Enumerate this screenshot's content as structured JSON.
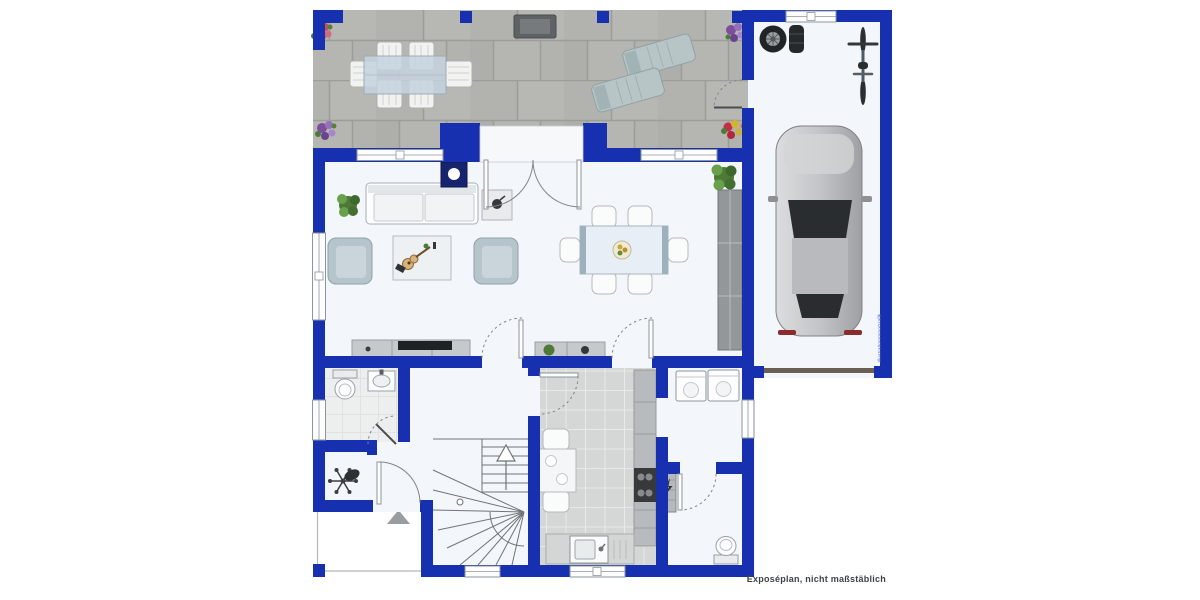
{
  "meta": {
    "type": "floor-plan",
    "footer_note": "Exposéplan, nicht maßstäblich",
    "watermark": "IllustrationImmoGrafik"
  },
  "colors": {
    "wall": "#1630b0",
    "floor": "#f3f6fa",
    "terrace_tile": "#b2b3af",
    "terrace_grout": "#9c9d99",
    "kitchen_tile": "#d4d7d5",
    "wc_tile": "#edefee",
    "cabinet_gray": "#c5c9cc",
    "seat_blue": "#b6c5cb",
    "plant_green": "#4e7a37",
    "arc_gray": "#80868c",
    "stair_gray": "#70757a",
    "text": "#3f4245",
    "watermark": "#4b63c6"
  },
  "inventory": {
    "terrace": [
      "outdoor-dining-table",
      "outdoor-chair-x6",
      "grill",
      "sun-lounger-x2",
      "flower-pot-x4",
      "terrace-gate"
    ],
    "garage": [
      "car",
      "bicycle",
      "tire-stack",
      "garage-door",
      "garage-window"
    ],
    "living_room": [
      "sofa",
      "side-table",
      "wood-stove",
      "armchair-x2",
      "coffee-table",
      "guitar",
      "tv-lowboard",
      "tv",
      "potted-plant"
    ],
    "dining_area": [
      "dining-table",
      "dining-chair-x6",
      "fruit-bowl",
      "sideboard",
      "tall-cabinet",
      "potted-plant"
    ],
    "kitchen": [
      "kitchen-table",
      "kitchen-chair-x2",
      "counter-with-stove",
      "counter-with-sink"
    ],
    "hallway": [
      "coat-rack",
      "entrance-arrow",
      "front-door"
    ],
    "guest_wc": [
      "toilet",
      "washbasin"
    ],
    "utility_room": [
      "washing-machine",
      "dryer"
    ],
    "technical_room": [
      "heater",
      "toilet"
    ],
    "staircase": [
      "winder-stairs",
      "direction-arrow"
    ]
  }
}
